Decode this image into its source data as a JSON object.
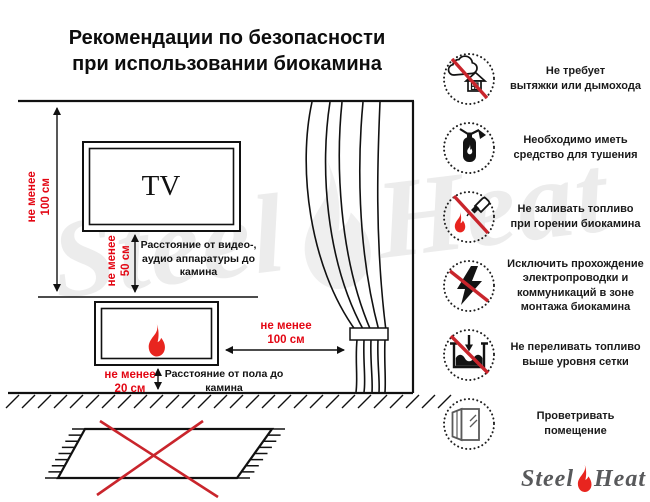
{
  "title": {
    "line1": "Рекомендации по безопасности",
    "line2": "при использовании биокамина"
  },
  "diagram": {
    "tv_label": "TV",
    "dim_ceiling": {
      "line1": "не менее",
      "line2": "100 см"
    },
    "dim_tv": {
      "line1": "не менее",
      "line2": "50 см"
    },
    "dim_curtain": {
      "line1": "не менее",
      "line2": "100 см"
    },
    "dim_floor": {
      "line1": "не менее",
      "line2": "20 см"
    },
    "note_av": {
      "line1": "Расстояние от видео-,",
      "line2": "аудио аппаратуры до",
      "line3": "камина"
    },
    "note_floor": {
      "line1": "Расстояние от пола до",
      "line2": "камина"
    }
  },
  "recommendations": [
    {
      "icon": "no-chimney-icon",
      "line1": "Не требует",
      "line2": "вытяжки или дымохода"
    },
    {
      "icon": "fire-extinguisher-icon",
      "line1": "Необходимо иметь",
      "line2": "средство для тушения"
    },
    {
      "icon": "no-refueling-while-burning-icon",
      "line1": "Не заливать топливо",
      "line2": "при горении биокамина"
    },
    {
      "icon": "no-electrical-wiring-icon",
      "line1": "Исключить прохождение",
      "line2": "электропроводки и",
      "line3": "коммуникаций в зоне",
      "line4": "монтажа биокамина"
    },
    {
      "icon": "no-overfilling-icon",
      "line1": "Не переливать топливо",
      "line2": "выше уровня сетки"
    },
    {
      "icon": "ventilate-room-icon",
      "line1": "Проветривать",
      "line2": "помещение"
    }
  ],
  "logo": {
    "steel": "Steel",
    "heat": "Heat"
  },
  "watermark": {
    "steel": "Steel",
    "heat": "Heat"
  },
  "colors": {
    "dimension_red": "#e30613",
    "prohibit_red": "#c9252c",
    "flame_red": "#e8251f"
  }
}
